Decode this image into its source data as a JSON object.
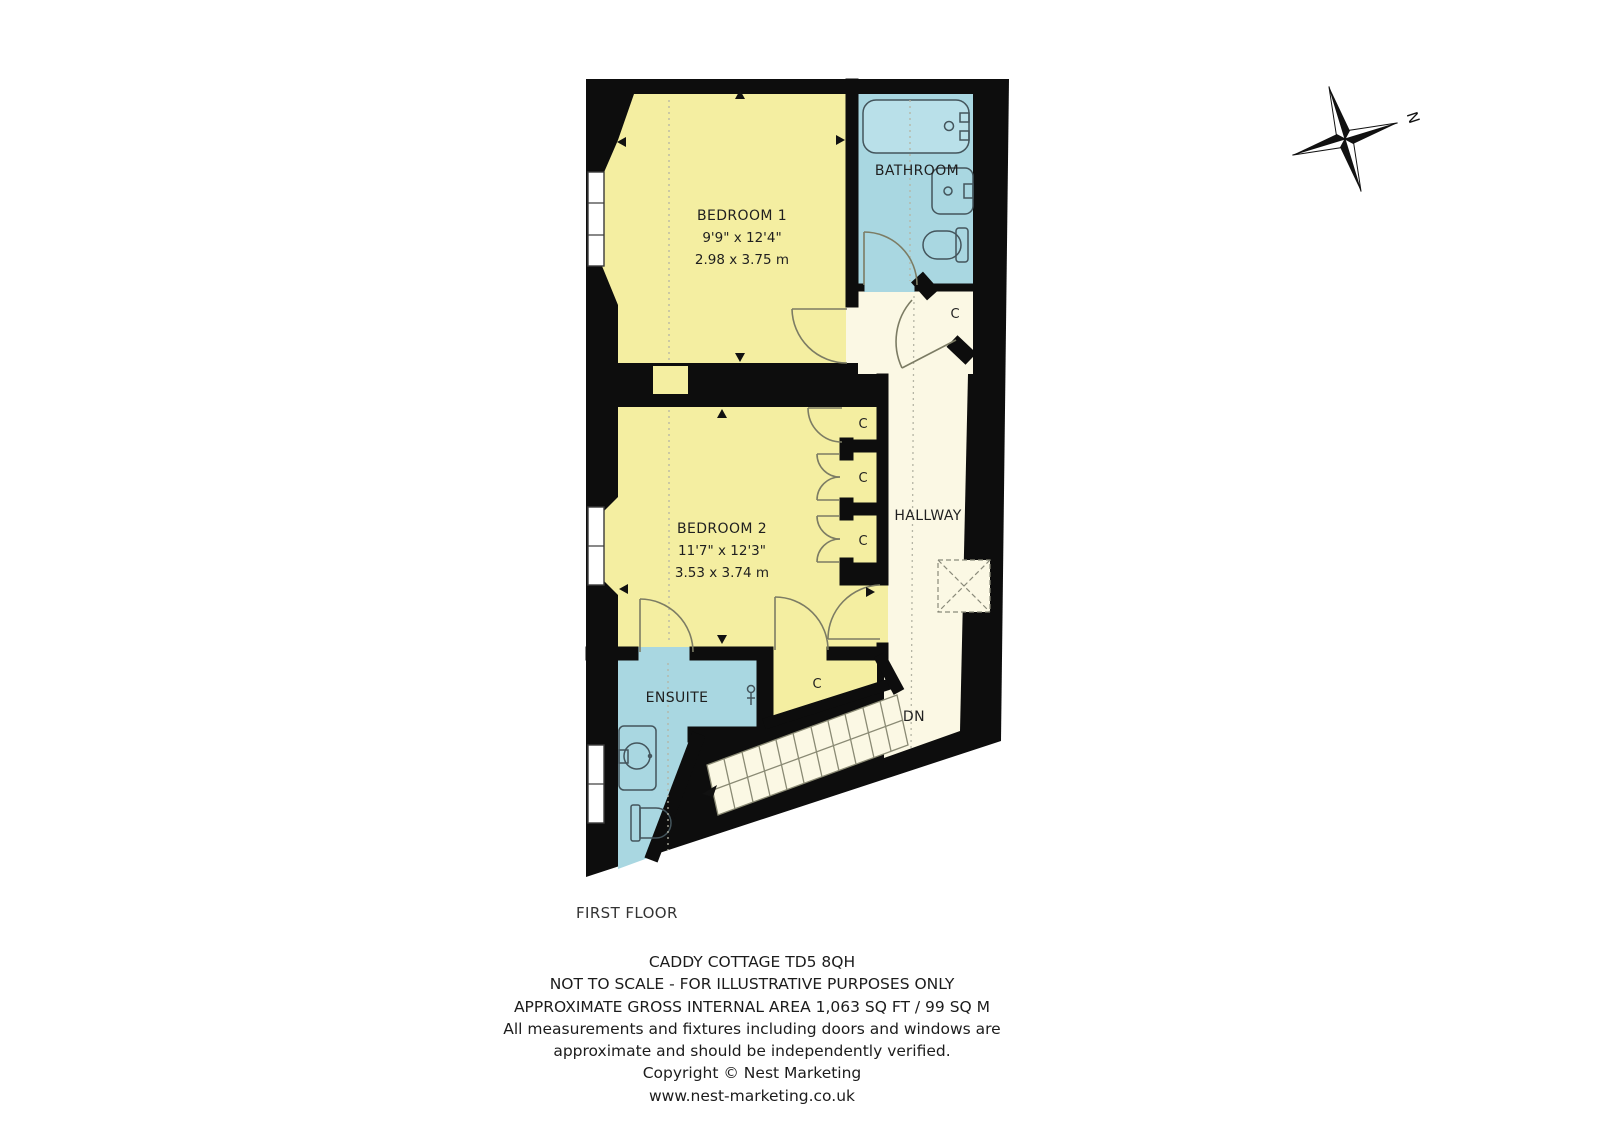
{
  "title_block": {
    "floor_label": "FIRST FLOOR",
    "address_line": "CADDY COTTAGE TD5 8QH",
    "disclaimer": "NOT TO SCALE - FOR ILLUSTRATIVE PURPOSES ONLY",
    "area_line": "APPROXIMATE GROSS INTERNAL AREA 1,063 SQ FT / 99 SQ M",
    "note_line1": "All measurements and fixtures including doors and windows are",
    "note_line2": "approximate and should be independently verified.",
    "copyright_line": "Copyright © Nest Marketing",
    "website": "www.nest-marketing.co.uk"
  },
  "compass": {
    "north_label": "N"
  },
  "rooms": {
    "bedroom1": {
      "name": "BEDROOM 1",
      "dim_imperial": "9'9\" x 12'4\"",
      "dim_metric": "2.98 x 3.75 m"
    },
    "bedroom2": {
      "name": "BEDROOM 2",
      "dim_imperial": "11'7\" x 12'3\"",
      "dim_metric": "3.53 x 3.74 m"
    },
    "bathroom": {
      "name": "BATHROOM"
    },
    "hallway": {
      "name": "HALLWAY"
    },
    "ensuite": {
      "name": "ENSUITE"
    }
  },
  "labels": {
    "closet": "C",
    "stairs_down": "DN"
  },
  "colors": {
    "room_yellow": "#f4eea1",
    "wet_room_blue": "#a9d7e1",
    "hallway_cream": "#fbf8e4",
    "wall_black": "#0d0d0d"
  }
}
